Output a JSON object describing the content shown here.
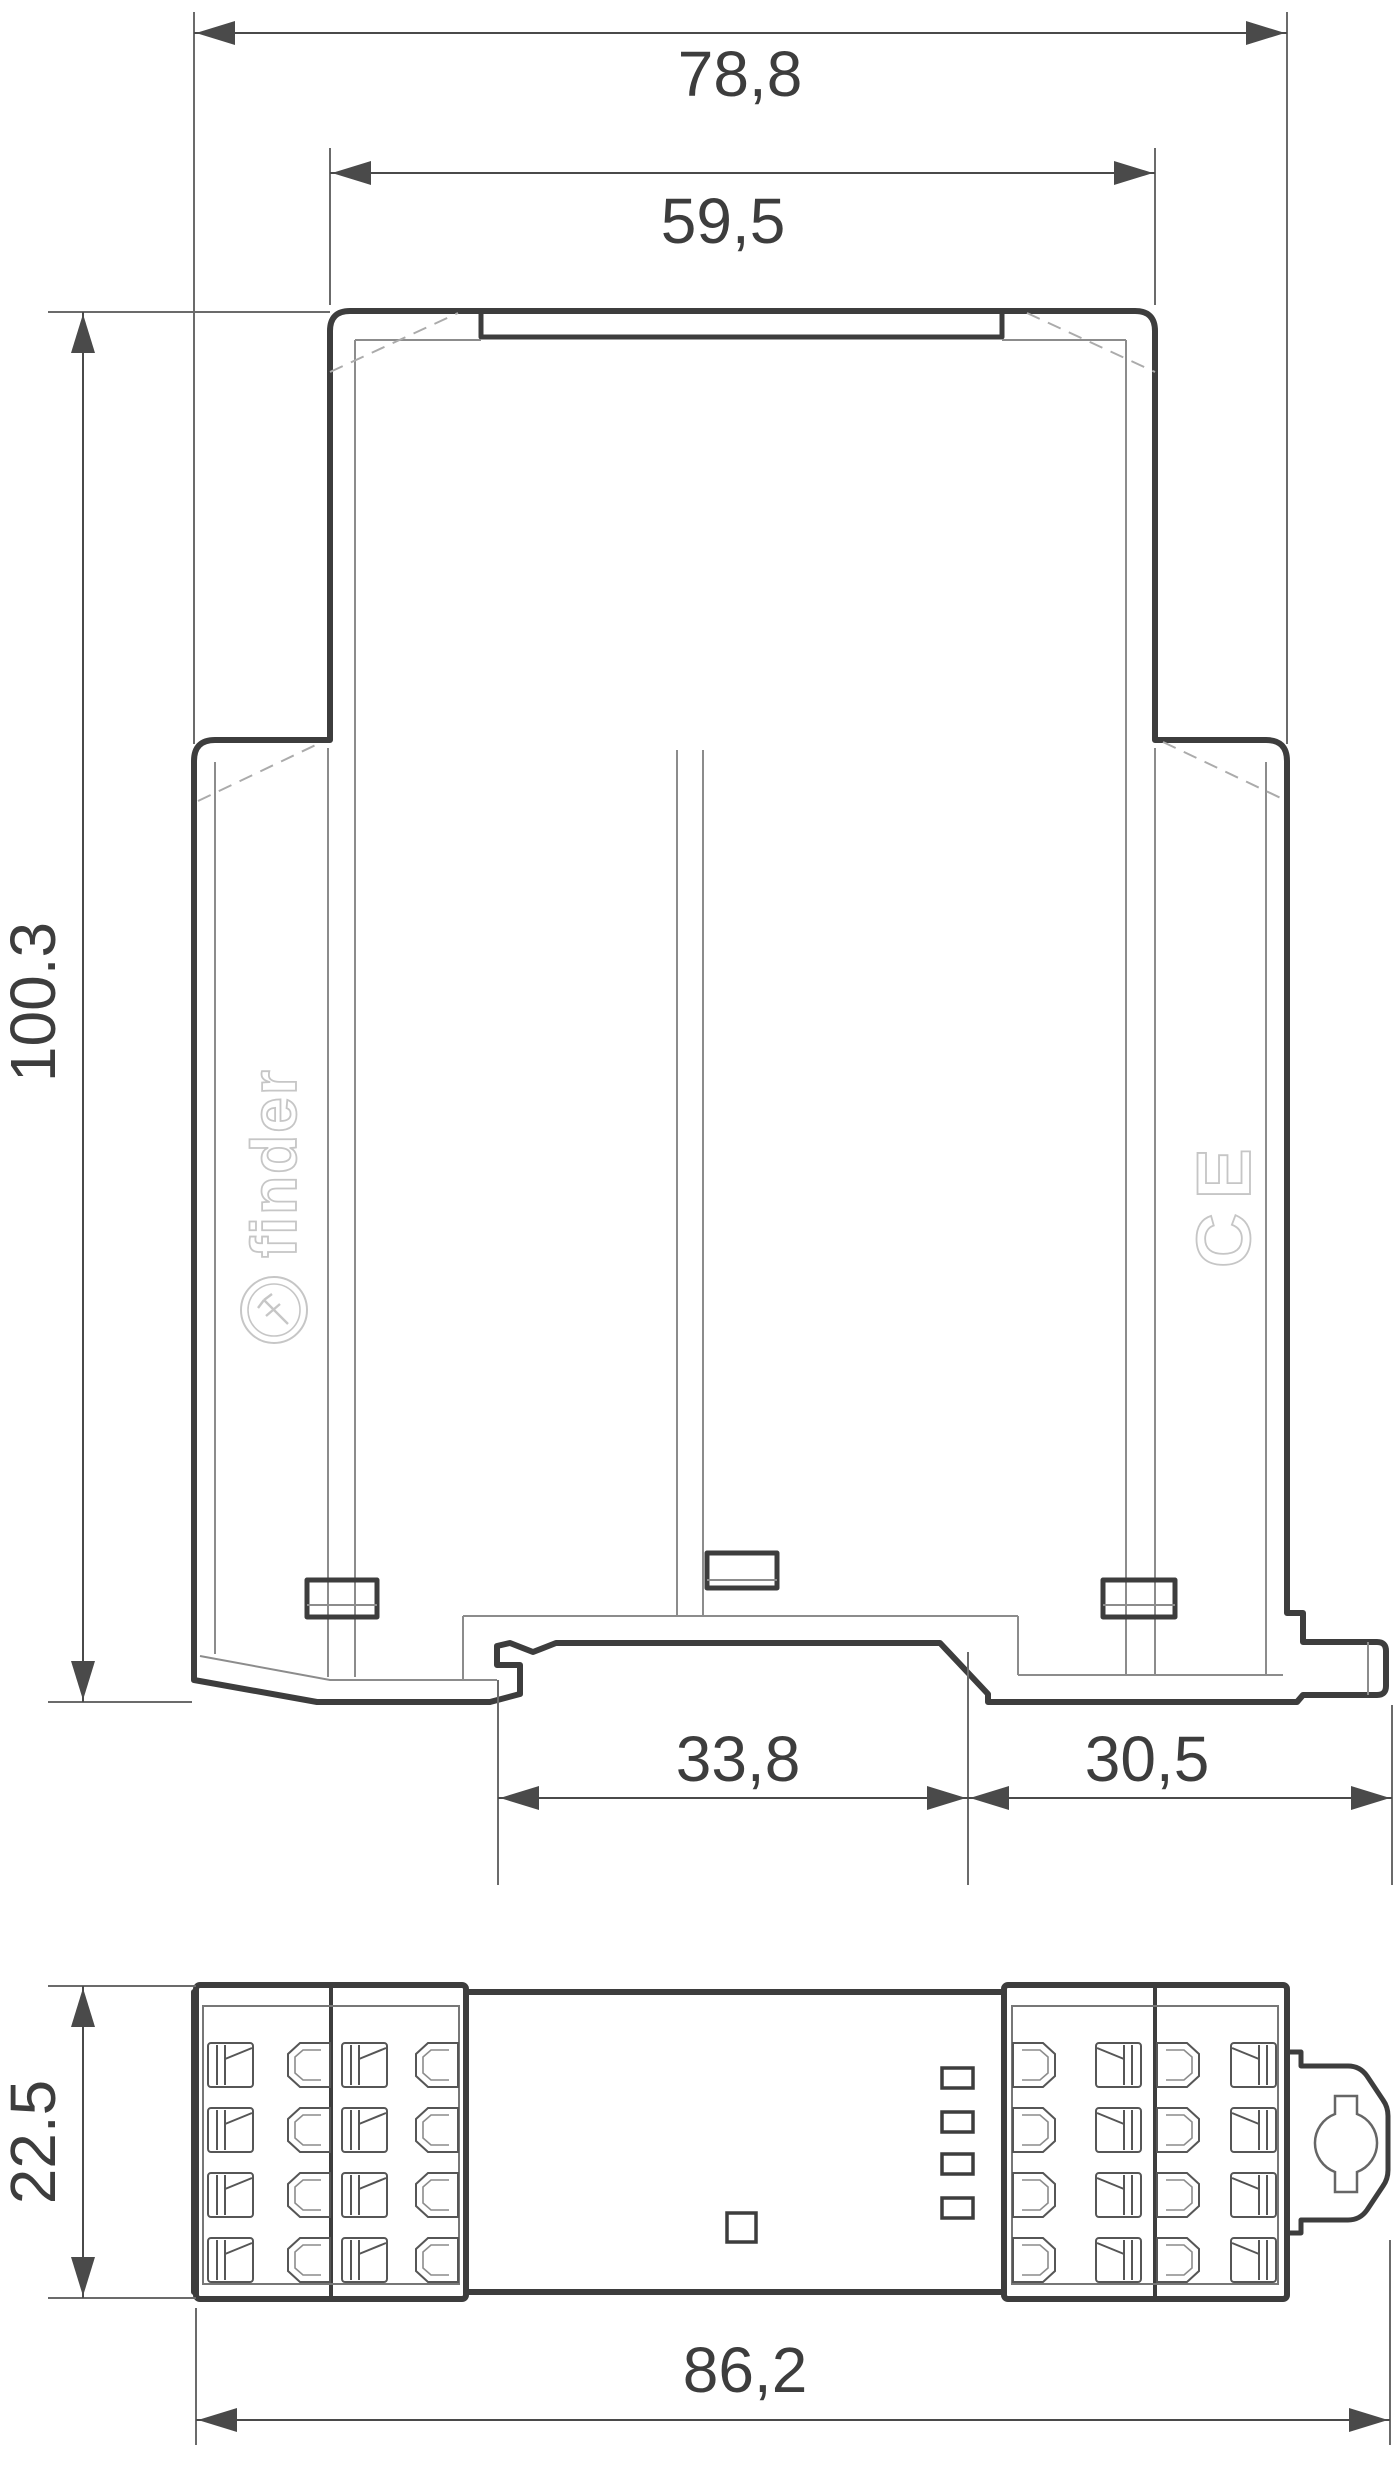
{
  "drawing": {
    "type": "dimensional-engineering-drawing",
    "dims": {
      "overall_width": "78,8",
      "upper_width": "59,5",
      "height": "100.3",
      "din_notch": "33,8",
      "foot_right": "30,5",
      "depth": "22.5",
      "overall_length": "86,2"
    },
    "branding": {
      "logo": "finder",
      "ce": "CE"
    },
    "colors": {
      "background": "#ffffff",
      "outline_dark": "#3d3d3d",
      "line_medium": "#565656",
      "line_thin": "#8c8c8c",
      "dashed": "#ababab",
      "dimension": "#4a4a4a",
      "logo_engraving": "#c6c6c6",
      "text": "#3d3d3d"
    },
    "terminals": {
      "rows": 4,
      "row_start_y": 2043,
      "row_pitch": 65,
      "cell_h": 44,
      "left_block": {
        "mirror": false,
        "groups": [
          {
            "screw_x": 208,
            "hex_x": 288
          },
          {
            "screw_x": 342,
            "hex_x": 416
          }
        ]
      },
      "right_block": {
        "mirror": true,
        "groups": [
          {
            "hex_x": 1013,
            "screw_x": 1096
          },
          {
            "hex_x": 1157,
            "screw_x": 1231
          }
        ]
      },
      "indicator_squares": {
        "x": 942,
        "w": 31,
        "h": 20,
        "ys": [
          2068,
          2112,
          2154,
          2198
        ]
      },
      "center_square": {
        "x": 727,
        "y": 2213,
        "size": 29
      }
    }
  }
}
